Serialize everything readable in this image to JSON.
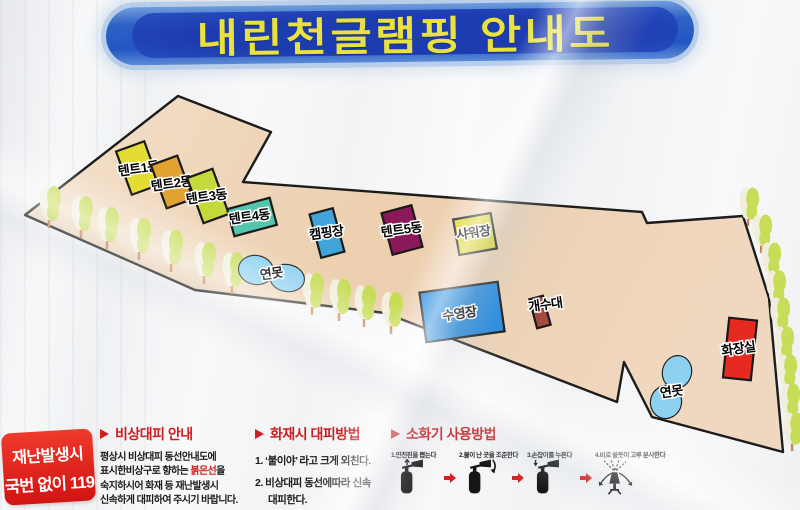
{
  "title": "내린천글램핑 안내도",
  "map": {
    "outline": "25,215 178,96 271,132 243,182 642,212 647,223 743,216 769,298 783,452 652,417 624,362 617,402 385,313 195,290",
    "fill_light": "#f3e0cb",
    "fill_dark": "#eccfae",
    "stroke": "#1c1c1c",
    "pond_fill": "#8dd0f0",
    "tree_green": "#c7dd58",
    "tree_cream": "#f2eedd",
    "buildings": [
      {
        "name": "tent-1",
        "label": "텐트1동",
        "cx": 138,
        "cy": 168,
        "w": 30,
        "h": 46,
        "rot": -20,
        "fill": "#e3dd33",
        "lx": 139,
        "ly": 173
      },
      {
        "name": "tent-2",
        "label": "텐트2동",
        "cx": 172,
        "cy": 182,
        "w": 28,
        "h": 46,
        "rot": -20,
        "fill": "#e2a231",
        "lx": 172,
        "ly": 188
      },
      {
        "name": "tent-3",
        "label": "텐트3동",
        "cx": 208,
        "cy": 196,
        "w": 27,
        "h": 48,
        "rot": -20,
        "fill": "#c6d93a",
        "lx": 207,
        "ly": 201
      },
      {
        "name": "tent-4",
        "label": "텐트4동",
        "cx": 252,
        "cy": 217,
        "w": 44,
        "h": 28,
        "rot": -15,
        "fill": "#54c5ad",
        "lx": 250,
        "ly": 221
      },
      {
        "name": "campsite",
        "label": "캠핑장",
        "cx": 327,
        "cy": 233,
        "w": 24,
        "h": 45,
        "rot": -15,
        "fill": "#40a3d9",
        "lx": 327,
        "ly": 237
      },
      {
        "name": "tent-5",
        "label": "텐트5동",
        "cx": 402,
        "cy": 230,
        "w": 31,
        "h": 43,
        "rot": -15,
        "fill": "#8b1959",
        "lx": 402,
        "ly": 234
      },
      {
        "name": "shower",
        "label": "샤워장",
        "cx": 475,
        "cy": 234,
        "w": 38,
        "h": 36,
        "rot": -10,
        "fill": "#ddd52d",
        "lx": 474,
        "ly": 237
      },
      {
        "name": "pool",
        "label": "수영장",
        "cx": 462,
        "cy": 312,
        "w": 79,
        "h": 50,
        "rot": -8,
        "fill": "#2389dd",
        "lx": 460,
        "ly": 318
      },
      {
        "name": "sink",
        "label": "개수대",
        "cx": 540,
        "cy": 312,
        "w": 14,
        "h": 30,
        "rot": -15,
        "fill": "#a44b3f",
        "lx": 546,
        "ly": 309
      },
      {
        "name": "toilet",
        "label": "화장실",
        "cx": 740,
        "cy": 349,
        "w": 28,
        "h": 60,
        "rot": 6,
        "fill": "#e52b21",
        "lx": 739,
        "ly": 353
      }
    ],
    "ponds": [
      {
        "name": "pond-upper",
        "label": "연못",
        "lobes": [
          [
            256,
            270,
            17,
            14,
            10
          ],
          [
            287,
            278,
            17,
            13,
            10
          ]
        ],
        "lx": 272,
        "ly": 278
      },
      {
        "name": "pond-lower",
        "label": "연못",
        "lobes": [
          [
            677,
            372,
            14,
            16,
            15
          ],
          [
            666,
            402,
            15,
            16,
            15
          ]
        ],
        "lx": 672,
        "ly": 396
      }
    ],
    "trees_left": [
      [
        50,
        204
      ],
      [
        82,
        214
      ],
      [
        108,
        225
      ],
      [
        140,
        236
      ],
      [
        172,
        248
      ],
      [
        205,
        260
      ],
      [
        233,
        270
      ],
      [
        313,
        291
      ],
      [
        340,
        297
      ],
      [
        365,
        303
      ],
      [
        392,
        310
      ]
    ],
    "trees_right": [
      [
        749,
        204
      ],
      [
        762,
        231
      ],
      [
        771,
        259
      ],
      [
        776,
        287
      ],
      [
        780,
        314
      ],
      [
        784,
        343
      ],
      [
        787,
        371
      ],
      [
        790,
        400
      ],
      [
        793,
        429
      ]
    ]
  },
  "emergency_box": {
    "line1": "재난발생시",
    "line2": "국번 없이 119",
    "bg": "#e11b1b"
  },
  "info_sections": [
    {
      "title": "비상대피 안내",
      "lines": [
        {
          "segs": [
            {
              "t": "평상시 비상대피 동선안내도에"
            }
          ]
        },
        {
          "segs": [
            {
              "t": "표시한비상구로 향하는 "
            },
            {
              "t": "붉은선",
              "red": true
            },
            {
              "t": "을"
            }
          ]
        },
        {
          "segs": [
            {
              "t": "숙지하시어 화재 등 재난발생시"
            }
          ]
        },
        {
          "segs": [
            {
              "t": "신속하게 대피하여 주시기 바랍니다."
            }
          ]
        }
      ]
    },
    {
      "title": "화재시 대피방법",
      "lines": [
        {
          "segs": [
            {
              "t": "1. ‘불이야’ 라고 크게 외친다."
            }
          ]
        },
        {
          "segs": [
            {
              "t": "2. 비상대피 동선에따라 신속"
            }
          ]
        },
        {
          "segs": [
            {
              "t": "대피한다."
            }
          ],
          "indent": true
        }
      ]
    },
    {
      "title": "소화기 사용방법",
      "steps": [
        {
          "caption": "1.안전핀을 뽑는다",
          "icon": "pin"
        },
        {
          "caption": "2.불이 난 곳을 조준한다",
          "icon": "aim"
        },
        {
          "caption": "3.손잡이를 누른다",
          "icon": "press"
        },
        {
          "caption": "4.비로 쓸듯이 고루 분사한다",
          "icon": "spray"
        }
      ]
    }
  ]
}
